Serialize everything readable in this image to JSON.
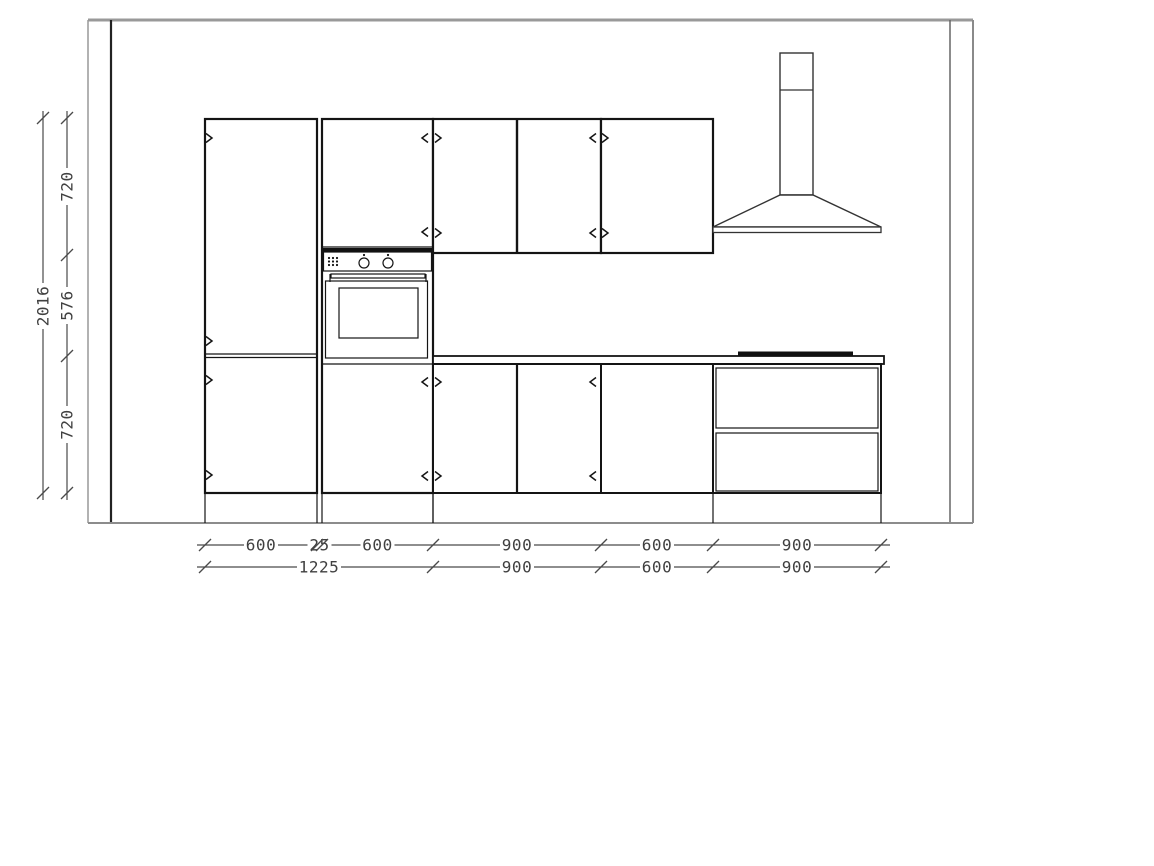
{
  "drawing": {
    "type": "kitchen-elevation-cad-drawing",
    "components": [
      "room-walls",
      "floor-line",
      "tall-cabinet",
      "filler-strip",
      "oven-housing",
      "built-in-oven",
      "wall-cabinet-900",
      "wall-cabinet-600",
      "cooker-hood",
      "countertop",
      "cooktop",
      "base-cabinet-900",
      "base-cabinet-600",
      "drawer-base-unit",
      "door-swing-arrows",
      "dimension-lines"
    ]
  },
  "dims": {
    "left_overall": "2016",
    "left_segments": [
      "720",
      "576",
      "720"
    ],
    "bottom_row1": [
      "600",
      "25",
      "600",
      "900",
      "600",
      "900"
    ],
    "bottom_row2": [
      "1225",
      "900",
      "600",
      "900"
    ]
  },
  "colors": {
    "background": "#ffffff",
    "cabinet_line": "#141414",
    "wall_line": "#8c8c8c",
    "dimension_line": "#4a4a4a",
    "dimension_text": "#404040"
  }
}
